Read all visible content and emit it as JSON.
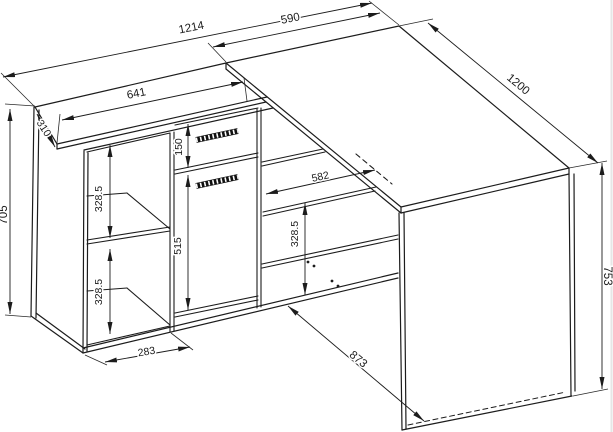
{
  "drawing": {
    "type": "furniture technical drawing",
    "subject": "corner desk with cabinet, drawer, door and open shelves",
    "line_color": "#1c1c1c",
    "background_color": "#ffffff",
    "units": "mm",
    "dimensions_mm": {
      "total_width": "1214",
      "desk_top_width": "590",
      "cabinet_top_width": "641",
      "desk_length": "1200",
      "cabinet_top_depth": "310",
      "cabinet_height": "705",
      "desk_height": "753",
      "drawer_front_height": "150",
      "door_height": "515",
      "left_shelf_top_height": "328.5",
      "left_shelf_bottom_height": "328.5",
      "right_shelf_height": "328.5",
      "inner_niche_width": "582",
      "left_bay_width": "283",
      "floor_depth_diagonal": "873"
    }
  }
}
